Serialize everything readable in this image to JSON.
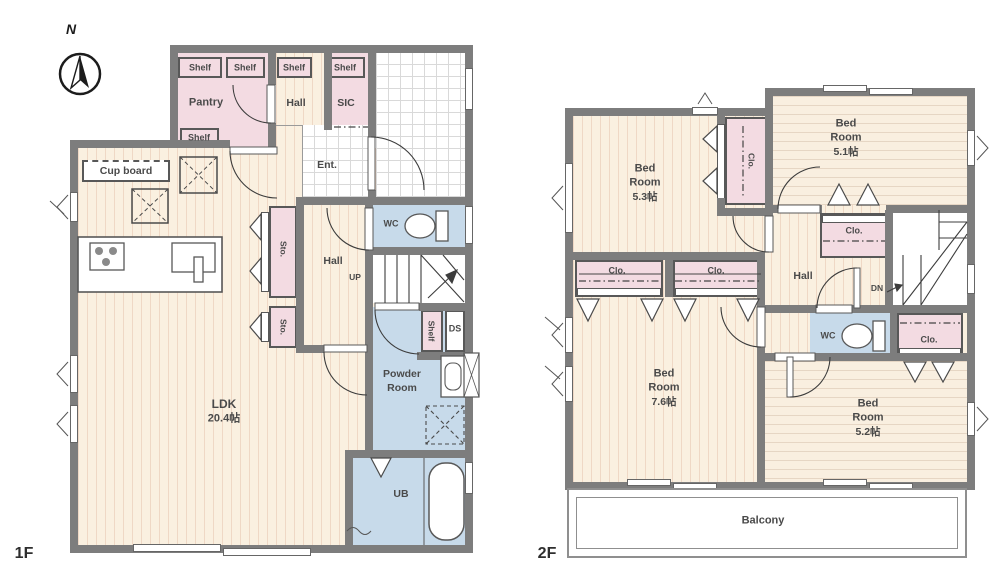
{
  "compass_label": "N",
  "colors": {
    "wall": "#7d7d7d",
    "wood": "#faf0e0",
    "pink": "#f3dbe2",
    "blue": "#c7daea",
    "tile_line": "#d9d9d9",
    "label_text": "#4a4a4a"
  },
  "floor1": {
    "floor_label": "1F",
    "labels": {
      "shelf": "Shelf",
      "pantry": "Pantry",
      "hall_upper": "Hall",
      "sic": "SIC",
      "ent": "Ent.",
      "cupboard": "Cup board",
      "ldk": "LDK",
      "ldk_size": "20.4帖",
      "sto": "Sto.",
      "hall": "Hall",
      "up": "UP",
      "wc": "WC",
      "ds": "DS",
      "powder1": "Powder",
      "powder2": "Room",
      "ub": "UB"
    }
  },
  "floor2": {
    "floor_label": "2F",
    "labels": {
      "bed": "Bed",
      "room": "Room",
      "size_53": "5.3帖",
      "size_51": "5.1帖",
      "size_76": "7.6帖",
      "size_52": "5.2帖",
      "clo": "Clo.",
      "hall": "Hall",
      "dn": "DN",
      "wc": "WC",
      "balcony": "Balcony"
    }
  }
}
